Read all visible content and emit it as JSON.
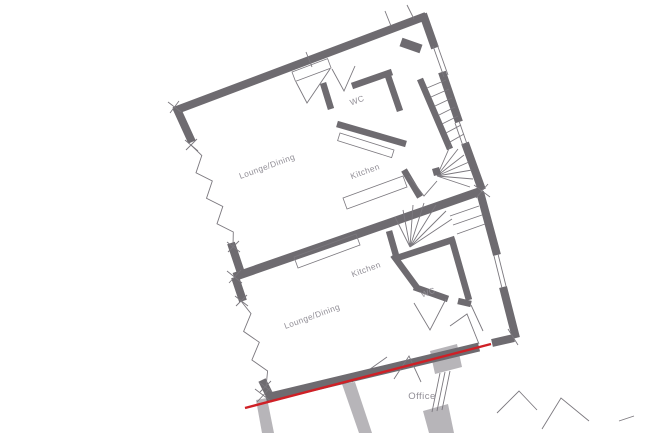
{
  "document": {
    "type": "architectural floor plan"
  },
  "colors": {
    "wall_dark": "#6e6b70",
    "wall_light": "#b7b5b9",
    "line_thin": "#7b787e",
    "boundary_red": "#cf2026",
    "label": "#908d95",
    "background": "#ffffff"
  },
  "rooms": {
    "upper_flat": {
      "lounge": "Lounge/Dining",
      "kitchen": "Kitchen",
      "wc": "WC"
    },
    "lower_flat": {
      "lounge": "Lounge/Dining",
      "kitchen": "Kitchen",
      "wc": "WC"
    },
    "ground_floor": {
      "office": "Office",
      "wc_partial": "WC"
    }
  }
}
